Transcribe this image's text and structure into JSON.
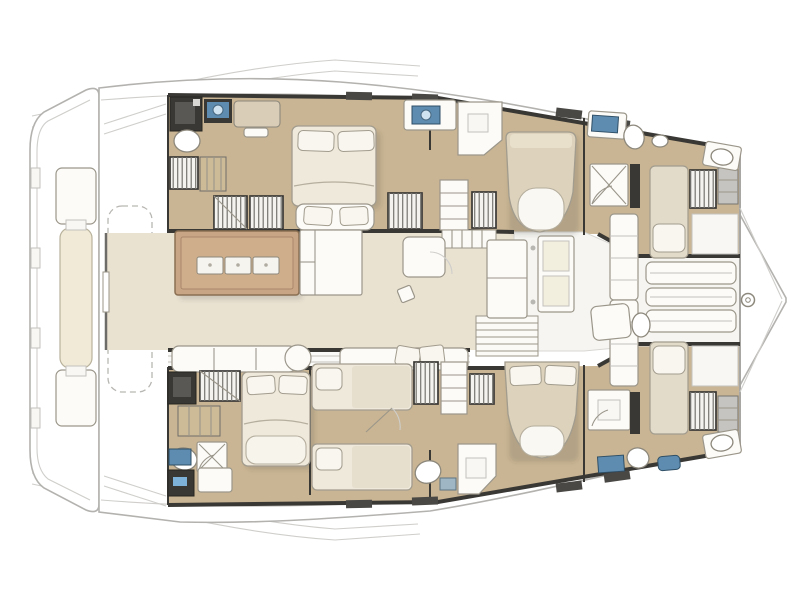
{
  "page": {
    "kind": "floor-plan-image",
    "subject": "catamaran-yacht-interior-layout",
    "canvas": {
      "width": 800,
      "height": 600
    },
    "background": "#ffffff"
  },
  "diagram": {
    "type": "boat-deck-plan",
    "orientation": {
      "bow": "right",
      "stern": "left",
      "port_hull": "top",
      "starboard_hull": "bottom"
    },
    "palette": {
      "deck_white": "#ffffff",
      "outline_gray": "#b3b2af",
      "faint_gray": "#cfcecb",
      "wood_floor": "#c9b593",
      "salon_floor": "#eae2d1",
      "foyer_white": "#f6f5f1",
      "wall_dark": "#3a3835",
      "wall_medium": "#6e6c68",
      "furniture_white": "#fcfbf8",
      "bed_linen": "#efe9db",
      "bed_duvet_tan": "#ddd2bb",
      "pillow_white": "#f9f6ef",
      "island_brown": "#c8a584",
      "island_top": "#cfae8c",
      "island_border": "#8a6f52",
      "stove_white": "#f6f4ef",
      "sink_blue": "#5e8cb0",
      "sink_bowl": "#cfe2f0",
      "screen_blue": "#7fb2d8",
      "locker_gray": "#c6c4c0",
      "bench_cream": "#f1ead6",
      "shadow": "rgba(60,58,54,0.16)"
    },
    "rooms": [
      {
        "id": "aft-deck",
        "name": "aft deck and swim platform",
        "location": "stern (left)"
      },
      {
        "id": "salon",
        "name": "salon with galley island",
        "location": "center bridgedeck"
      },
      {
        "id": "foyer",
        "name": "forward foyer with companionway stairs",
        "location": "center forward"
      },
      {
        "id": "bow-platform",
        "name": "bow platform with bench seats and forestay ring",
        "location": "bow (right)"
      },
      {
        "id": "port-aft-cabin",
        "name": "port aft double cabin with ensuite shower room",
        "location": "port hull aft"
      },
      {
        "id": "port-mid-cabin",
        "name": "port middle double cabin with washroom",
        "location": "port hull middle"
      },
      {
        "id": "port-fwd-cabin",
        "name": "port forward single cabin with ensuite",
        "location": "port hull forward"
      },
      {
        "id": "stbd-aft-cabin",
        "name": "starboard aft double cabin with ensuite shower room",
        "location": "starboard hull aft"
      },
      {
        "id": "stbd-twin-cabin",
        "name": "starboard twin-berth cabin",
        "location": "starboard hull middle-aft"
      },
      {
        "id": "stbd-mid-cabin",
        "name": "starboard middle double cabin with washroom",
        "location": "starboard hull middle-fwd"
      },
      {
        "id": "stbd-fwd-cabin",
        "name": "starboard forward single cabin with ensuite",
        "location": "starboard hull forward"
      }
    ],
    "furniture_counts": {
      "double_beds": 4,
      "single_berths": 4,
      "showers": 6,
      "toilets": 6,
      "washbasins": 8,
      "hatched_wardrobes": 9,
      "step_flights": 6,
      "galley_island_burners": 3,
      "dining_table": 1,
      "salon_sofas": 2,
      "bow_bench_slats": 3,
      "engine_hatch_dashed": 1
    }
  }
}
